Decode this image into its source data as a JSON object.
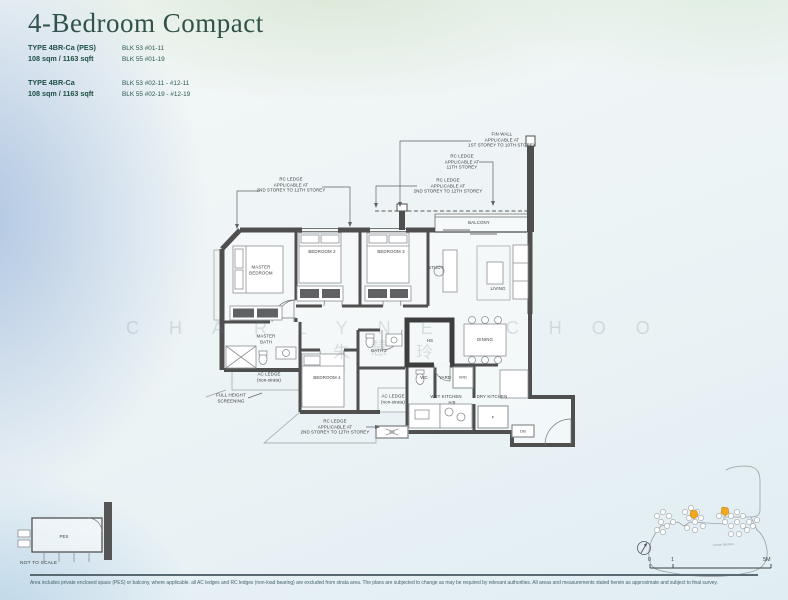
{
  "title": "4-Bedroom Compact",
  "unit_types": [
    {
      "name": "TYPE 4BR-Ca (PES)",
      "area": "108 sqm / 1163 sqft",
      "blocks": [
        "BLK 53 #01-11",
        "BLK 55 #01-19"
      ]
    },
    {
      "name": "TYPE 4BR-Ca",
      "area": "108 sqm / 1163 sqft",
      "blocks": [
        "BLK 53 #02-11 - #12-11",
        "BLK 55 #02-19 - #12-19"
      ]
    }
  ],
  "plan": {
    "rooms": {
      "master_bedroom": [
        "MASTER",
        "BEDROOM"
      ],
      "bedroom_2": "BEDROOM 2",
      "bedroom_3": "BEDROOM 3",
      "bedroom_4": "BEDROOM 4",
      "study": "STUDY",
      "living": "LIVING",
      "balcony": "BALCONY",
      "dining": "DINING",
      "master_bath": [
        "MASTER",
        "BATH"
      ],
      "bath_2": "BATH 2",
      "hs": "HS",
      "wc": "WC",
      "yard": "YARD",
      "wd": "W/D",
      "wet_kitchen": "WET KITCHEN",
      "dry_kitchen": "DRY KITCHEN",
      "hob": "H/B",
      "fridge": "F",
      "db": "DB",
      "pes": "PES"
    },
    "annotations": {
      "fin_wall": [
        "FIN WALL",
        "APPLICABLE AT",
        "1ST STOREY TO 10TH STOREY"
      ],
      "rc_ledge_11th": [
        "RC LEDGE",
        "APPLICABLE AT",
        "11TH STOREY"
      ],
      "rc_ledge_right": [
        "RC LEDGE",
        "APPLICABLE AT",
        "2ND STOREY TO 12TH STOREY"
      ],
      "rc_ledge_left": [
        "RC LEDGE",
        "APPLICABLE AT",
        "2ND STOREY TO 12TH STOREY"
      ],
      "rc_ledge_bottom": [
        "RC LEDGE",
        "APPLICABLE AT",
        "2ND STOREY TO 12TH STOREY"
      ],
      "ac_ledge_1": [
        "AC LEDGE",
        "(non-strata)"
      ],
      "ac_ledge_2": [
        "AC LEDGE",
        "(non-strata)"
      ],
      "full_height_screening": [
        "FULL HEIGHT",
        "SCREENING"
      ]
    }
  },
  "watermark": {
    "name": "CHARLYNE CHOO",
    "cjk_1": "朱",
    "cjk_2": "慧",
    "cjk_3": "玲"
  },
  "site_map": {
    "road_label": "Lentor Gardens",
    "scale_0": "0",
    "scale_1": "1",
    "scale_5m": "5M"
  },
  "footer": {
    "not_to_scale": "NOT TO SCALE",
    "disclaimer": "Area includes private enclosed space (PES) or balcony, where applicable. all AC ledges and RC ledges (non-load bearing) are excluded from strata area. The plans are subjected to change as may be required by relevant authorities. All areas and measurements stated herein as approximate and subject to final survey."
  },
  "colors": {
    "heading": "#31524a",
    "wall": "#4f4f4f",
    "highlight_building": "#f2a71d"
  }
}
